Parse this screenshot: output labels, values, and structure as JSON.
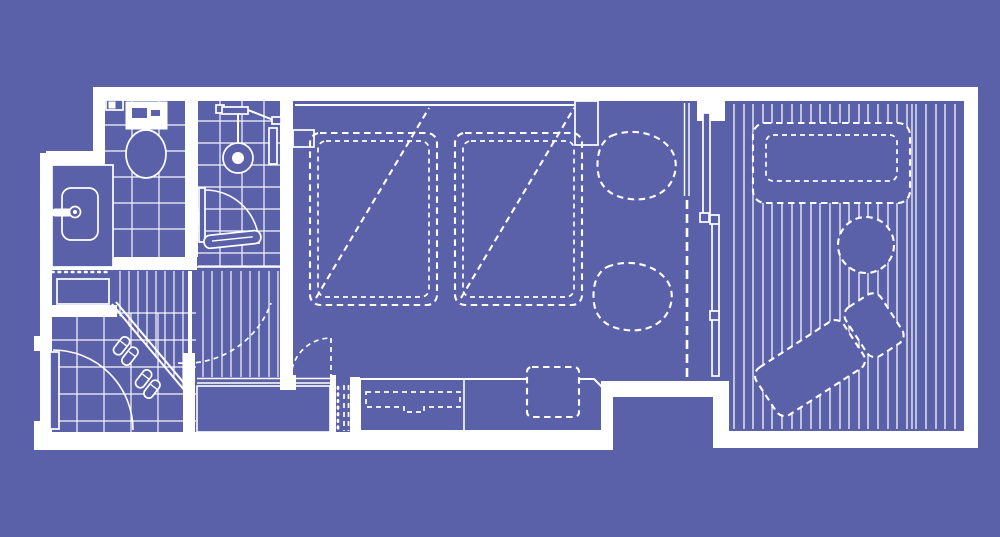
{
  "meta": {
    "aria_label": "Blueprint style floor plan of a hotel guest room with bathroom, twin bedroom and wood deck terrace",
    "diagram_type": "architectural-floor-plan"
  },
  "colors": {
    "background": "#5A61A9",
    "line": "#FFFFFF"
  },
  "areas": {
    "toilet_room": {
      "elements": [
        "tile-grid-floor",
        "toilet",
        "paper-holder"
      ]
    },
    "shower_room": {
      "elements": [
        "tile-grid-floor",
        "shower-head",
        "shower-controls",
        "glass-door",
        "bench"
      ]
    },
    "vanity": {
      "elements": [
        "counter",
        "sink-basin",
        "faucet",
        "towel-rail",
        "cabinet"
      ]
    },
    "entry": {
      "elements": [
        "tile-grid-floor",
        "entrance-door-swing",
        "slippers-pair-1",
        "slippers-pair-2",
        "step-edge"
      ]
    },
    "hallway": {
      "elements": [
        "wood-plank-floor",
        "door-swing-dashed"
      ]
    },
    "closet": {
      "elements": [
        "closet-box",
        "front-rail",
        "luggage-rack-dashed"
      ]
    },
    "bedroom": {
      "elements": [
        "headboard-ledge",
        "twin-bed-1",
        "twin-bed-2",
        "bed-diagonal-1",
        "bed-diagonal-2",
        "armchair-1",
        "armchair-2",
        "room-door-swing",
        "media-counter",
        "tv-dashed",
        "stool-dashed"
      ]
    },
    "partition": {
      "elements": [
        "curtain-rail",
        "curtain-dashed",
        "sliding-glass-panel-1",
        "sliding-glass-panel-2",
        "panel-handles"
      ]
    },
    "terrace": {
      "elements": [
        "deck-board-floor",
        "outdoor-bench-dashed",
        "side-table-dashed",
        "lounge-chair-dashed"
      ]
    }
  }
}
